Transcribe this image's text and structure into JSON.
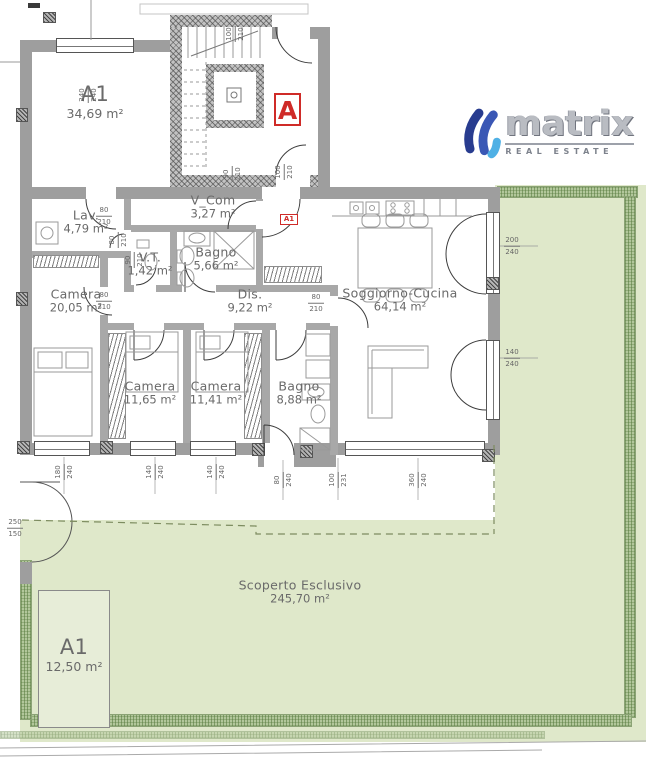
{
  "logo": {
    "brand": "matrix",
    "tagline": "REAL ESTATE"
  },
  "badges": {
    "unit": "A",
    "entry": "A1"
  },
  "colors": {
    "accent_red": "#cf2b28",
    "garden_green": "#dfe8ca",
    "hedge_green": "#b2c79b",
    "wall_gray": "#9e9e9e",
    "logo_dark_blue": "#283c8f",
    "logo_mid_blue": "#3a57b5",
    "logo_light_blue": "#4fb0e5"
  },
  "rooms": [
    {
      "name": "A1",
      "area": "34,69 m²",
      "x": 95,
      "y": 102,
      "big": true
    },
    {
      "name": "Lav.",
      "area": "4,79 m²",
      "x": 86,
      "y": 222
    },
    {
      "name": "V_Com",
      "area": "3,27 m²",
      "x": 213,
      "y": 207
    },
    {
      "name": "V.T.",
      "area": "1,42 m²",
      "x": 150,
      "y": 264
    },
    {
      "name": "Bagno",
      "area": "5,66 m²",
      "x": 216,
      "y": 259
    },
    {
      "name": "Camera",
      "area": "20,05 m²",
      "x": 76,
      "y": 301
    },
    {
      "name": "Dis.",
      "area": "9,22 m²",
      "x": 250,
      "y": 301
    },
    {
      "name": "Soggiorno-Cucina",
      "area": "64,14 m²",
      "x": 400,
      "y": 300
    },
    {
      "name": "Camera",
      "area": "11,65 m²",
      "x": 150,
      "y": 393
    },
    {
      "name": "Camera",
      "area": "11,41 m²",
      "x": 216,
      "y": 393
    },
    {
      "name": "Bagno",
      "area": "8,88 m²",
      "x": 299,
      "y": 393
    },
    {
      "name": "Scoperto Esclusivo",
      "area": "245,70 m²",
      "x": 300,
      "y": 592
    },
    {
      "name": "A1",
      "area": "12,50 m²",
      "x": 74,
      "y": 655,
      "big": true
    }
  ],
  "dimensions": [
    {
      "a": "240",
      "b": "240",
      "x": 88,
      "y": 95,
      "v": true
    },
    {
      "a": "100",
      "b": "210",
      "x": 235,
      "y": 34,
      "v": true
    },
    {
      "a": "90",
      "b": "210",
      "x": 232,
      "y": 174,
      "v": true
    },
    {
      "a": "100",
      "b": "210",
      "x": 284,
      "y": 172,
      "v": true
    },
    {
      "a": "80",
      "b": "210",
      "x": 104,
      "y": 216,
      "v": false
    },
    {
      "a": "80",
      "b": "210",
      "x": 118,
      "y": 240,
      "v": true
    },
    {
      "a": "90",
      "b": "210",
      "x": 134,
      "y": 260,
      "v": true
    },
    {
      "a": "80",
      "b": "210",
      "x": 104,
      "y": 301,
      "v": false
    },
    {
      "a": "80",
      "b": "210",
      "x": 316,
      "y": 303,
      "v": false
    },
    {
      "a": "200",
      "b": "240",
      "x": 512,
      "y": 246,
      "v": false
    },
    {
      "a": "140",
      "b": "240",
      "x": 512,
      "y": 358,
      "v": false
    },
    {
      "a": "180",
      "b": "240",
      "x": 64,
      "y": 472,
      "v": true
    },
    {
      "a": "140",
      "b": "240",
      "x": 155,
      "y": 472,
      "v": true
    },
    {
      "a": "140",
      "b": "240",
      "x": 216,
      "y": 472,
      "v": true
    },
    {
      "a": "80",
      "b": "240",
      "x": 283,
      "y": 480,
      "v": true
    },
    {
      "a": "100",
      "b": "231",
      "x": 338,
      "y": 480,
      "v": true
    },
    {
      "a": "360",
      "b": "240",
      "x": 418,
      "y": 480,
      "v": true
    },
    {
      "a": "250",
      "b": "150",
      "x": 15,
      "y": 528,
      "v": false
    }
  ]
}
